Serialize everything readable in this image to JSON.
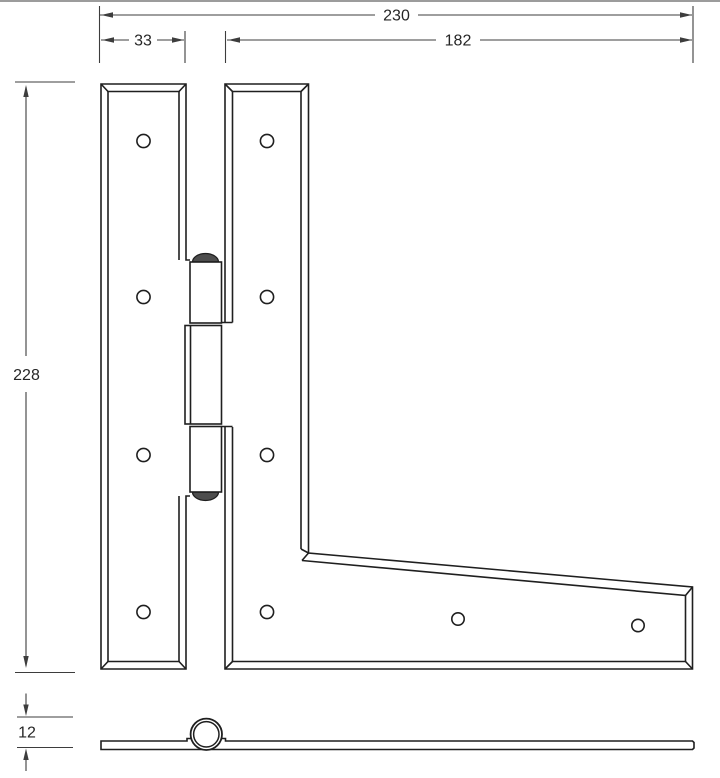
{
  "drawing": {
    "dim_total_width": "230",
    "dim_left_leaf_width": "33",
    "dim_right_leaf_width": "182",
    "dim_height": "228",
    "dim_thickness": "12"
  },
  "colors": {
    "background": "#ffffff",
    "drawing_line": "#1f1f1f",
    "dimension_line": "#3d3d3d",
    "text_color": "#262626",
    "pin_cap_fill": "#4d4d4d",
    "page_border": "#9c9c9c"
  }
}
